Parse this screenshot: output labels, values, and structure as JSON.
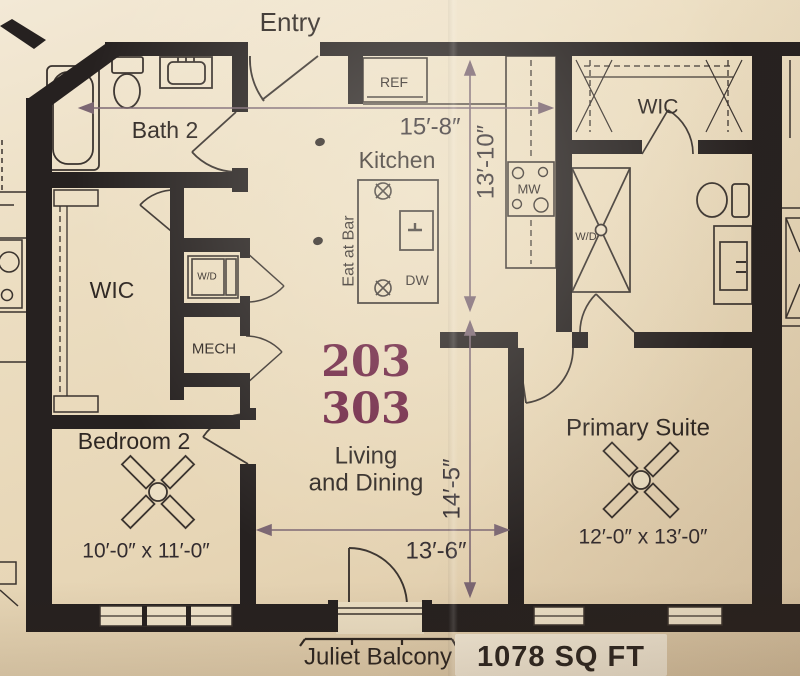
{
  "unit": {
    "numbers": [
      "203",
      "303"
    ],
    "area_label": "1078 SQ FT"
  },
  "labels": {
    "entry": "Entry",
    "bath2": "Bath 2",
    "wic": "WIC",
    "mech": "MECH",
    "kitchen": "Kitchen",
    "bedroom2": "Bedroom 2",
    "primary_suite": "Primary Suite",
    "living_line1": "Living",
    "living_line2": "and Dining",
    "juliet_balcony": "Juliet Balcony"
  },
  "appliances": {
    "ref": "REF",
    "mw": "MW",
    "dw": "DW",
    "wd": "W/D",
    "eat_at_bar": "Eat at Bar"
  },
  "dimensions": {
    "kitchen_width": "15′-8″",
    "kitchen_depth": "13′-10″",
    "living_depth": "14′-5″",
    "living_width": "13′-6″",
    "bedroom2_size": "10′-0″ x 11′-0″",
    "primary_size": "12′-0″ x 13′-0″"
  },
  "colors": {
    "paper": "#ecdfc4",
    "wall": "#262120",
    "line": "#3a332e",
    "dimension_line": "#7b6672",
    "unit_number": "#6d2242"
  }
}
